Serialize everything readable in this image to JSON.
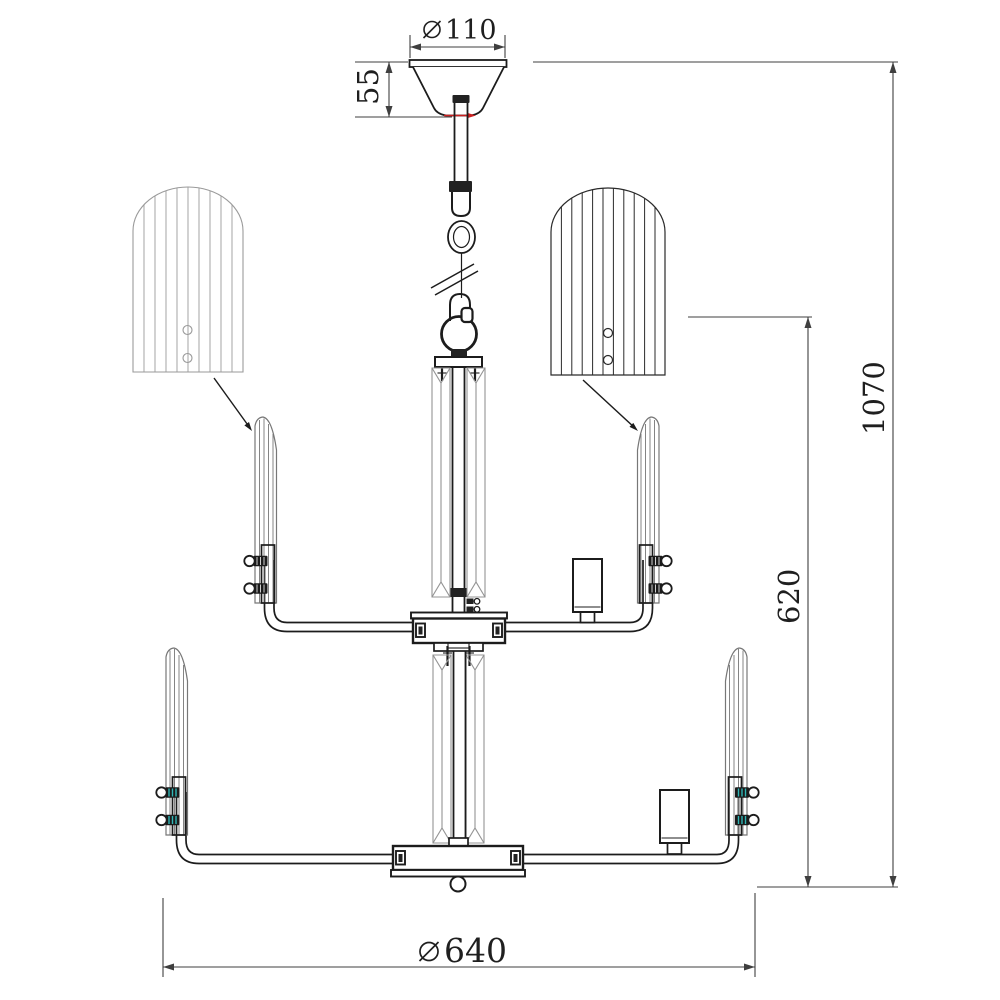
{
  "drawing": {
    "title": "chandelier-dimension-drawing",
    "dimensions": {
      "canopy_diameter": {
        "symbol": "⌀",
        "value": "110"
      },
      "canopy_height": {
        "value": "55"
      },
      "total_height": {
        "value": "1070"
      },
      "body_height": {
        "value": "620"
      },
      "fixture_diameter": {
        "symbol": "⌀",
        "value": "640"
      }
    },
    "colors": {
      "background": "#ffffff",
      "main_line": "#1c1c1c",
      "glass_line": "#949494",
      "dimension_line": "#3f3f3f",
      "detail_shade_left": "#9a9a9a",
      "detail_shade_right": "#2a2a2a",
      "accent_red": "#cc2020",
      "accent_teal": "#2fb5b5"
    }
  }
}
